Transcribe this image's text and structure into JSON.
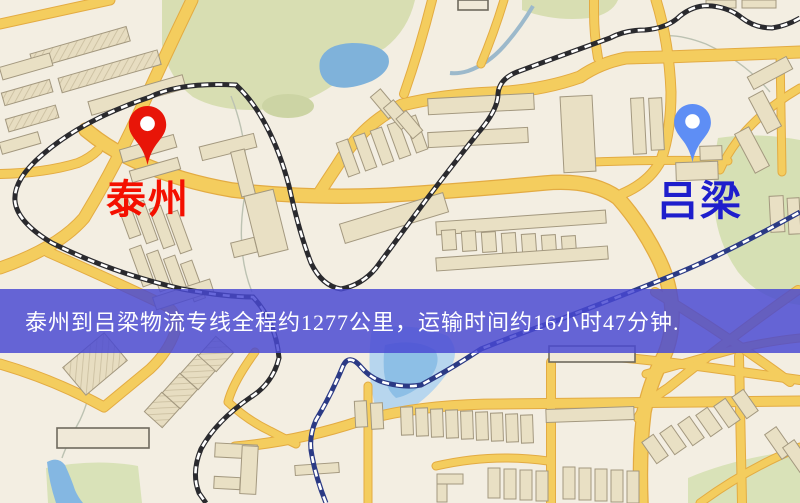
{
  "type": "logistics-route-map",
  "banner": {
    "text": "泰州到吕梁物流专线全程约1277公里，运输时间约16小时47分钟.",
    "bg_color": "#4848d3",
    "text_color": "#ffffff"
  },
  "map": {
    "origin_label": "泰州",
    "dest_label": "吕梁",
    "origin_pin_color": "#e81508",
    "dest_pin_color": "#5e8ef5",
    "origin_label_color": "#f41000",
    "dest_label_color": "#1e1ecc",
    "background_color": "#f3eee2",
    "road_color": "#f4cd5e",
    "park_color": "#d8deb2",
    "water_color": "#86b9e2",
    "railway_color": "#2a2a2e"
  },
  "route": {
    "origin": "泰州",
    "destination": "吕梁",
    "distance_text": "约1277公里",
    "duration_text": "约16小时47分钟"
  }
}
